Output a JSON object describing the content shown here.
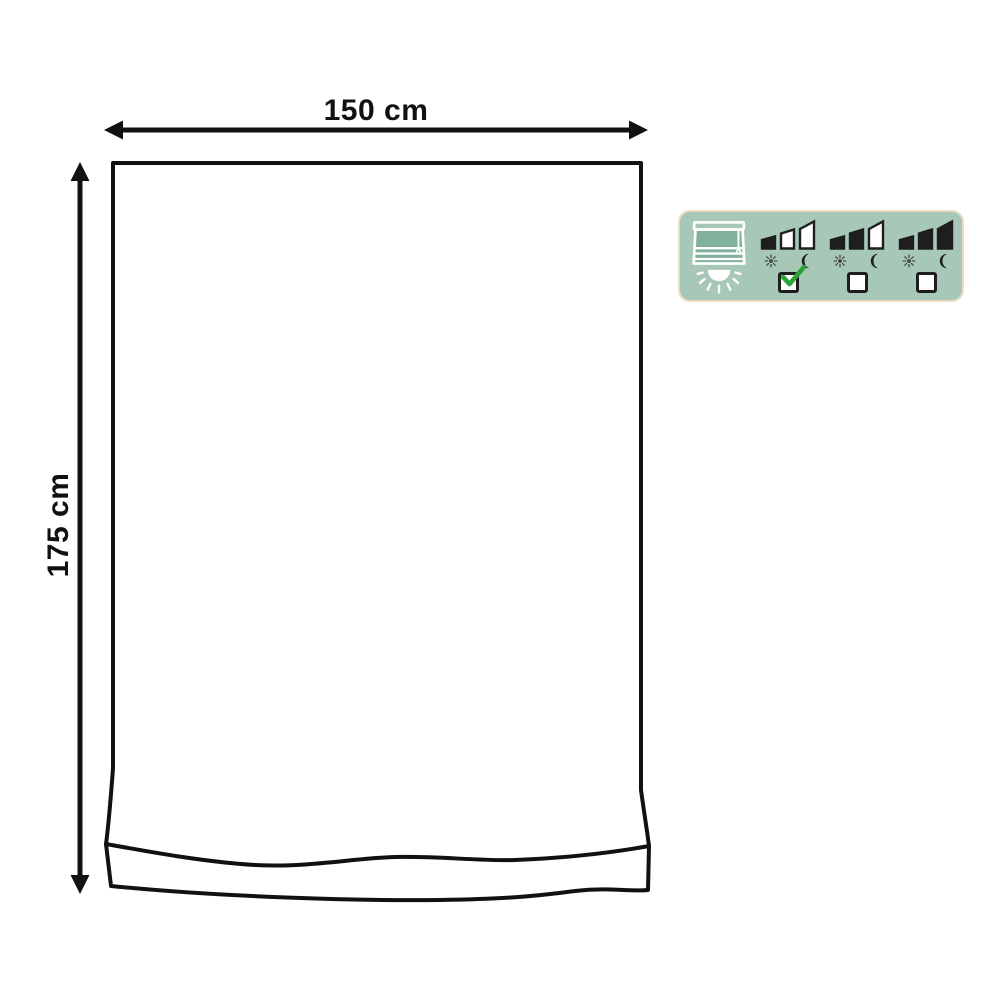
{
  "page": {
    "background": "#ffffff"
  },
  "diagram": {
    "subject": "curtain-outline-drawing",
    "width_label": "150 cm",
    "height_label": "175 cm",
    "line_color": "#111111"
  },
  "badge": {
    "background": "#a7c8b6",
    "border_color": "#e9dcc2",
    "icon_dark": "#1e1e1e",
    "sun_color": "#4a4a4a",
    "check_color": "#2da23c",
    "blind_icon": "roman-blind-with-light-icon",
    "options": [
      {
        "name": "light-blocking-level-1",
        "bars_filled": 1,
        "bars_total": 3,
        "icons": [
          "sun-icon",
          "moon-icon"
        ],
        "checked": true
      },
      {
        "name": "light-blocking-level-2",
        "bars_filled": 2,
        "bars_total": 3,
        "icons": [
          "sun-icon",
          "moon-icon"
        ],
        "checked": false
      },
      {
        "name": "light-blocking-level-3",
        "bars_filled": 3,
        "bars_total": 3,
        "icons": [
          "sun-icon",
          "moon-icon"
        ],
        "checked": false
      }
    ]
  }
}
